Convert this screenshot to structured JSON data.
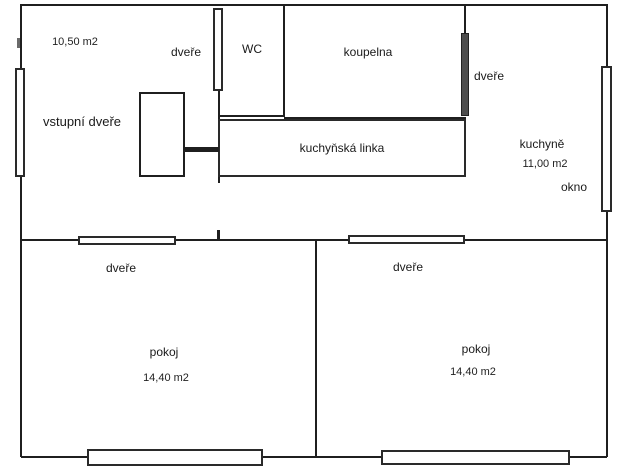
{
  "plan_title": "apartment-floor-plan",
  "colors": {
    "wall": "#1f1f1f",
    "opening_fill": "#ffffff",
    "dark_door_fill": "#4d4d4d",
    "background": "#ffffff",
    "text": "#1a1a1a"
  },
  "rooms": {
    "hall": {
      "area": "10,50 m2",
      "entrance_door_label": "vstupní dveře",
      "door_label": "dveře"
    },
    "wc": {
      "label": "WC"
    },
    "bathroom": {
      "label": "koupelna",
      "door_label": "dveře"
    },
    "kitchen": {
      "label": "kuchyně",
      "area": "11,00 m2",
      "window_label": "okno",
      "counter_label": "kuchyňská linka"
    },
    "room_left": {
      "label": "pokoj",
      "area": "14,40 m2",
      "door_label": "dveře"
    },
    "room_right": {
      "label": "pokoj",
      "area": "14,40 m2",
      "door_label": "dveře"
    }
  }
}
